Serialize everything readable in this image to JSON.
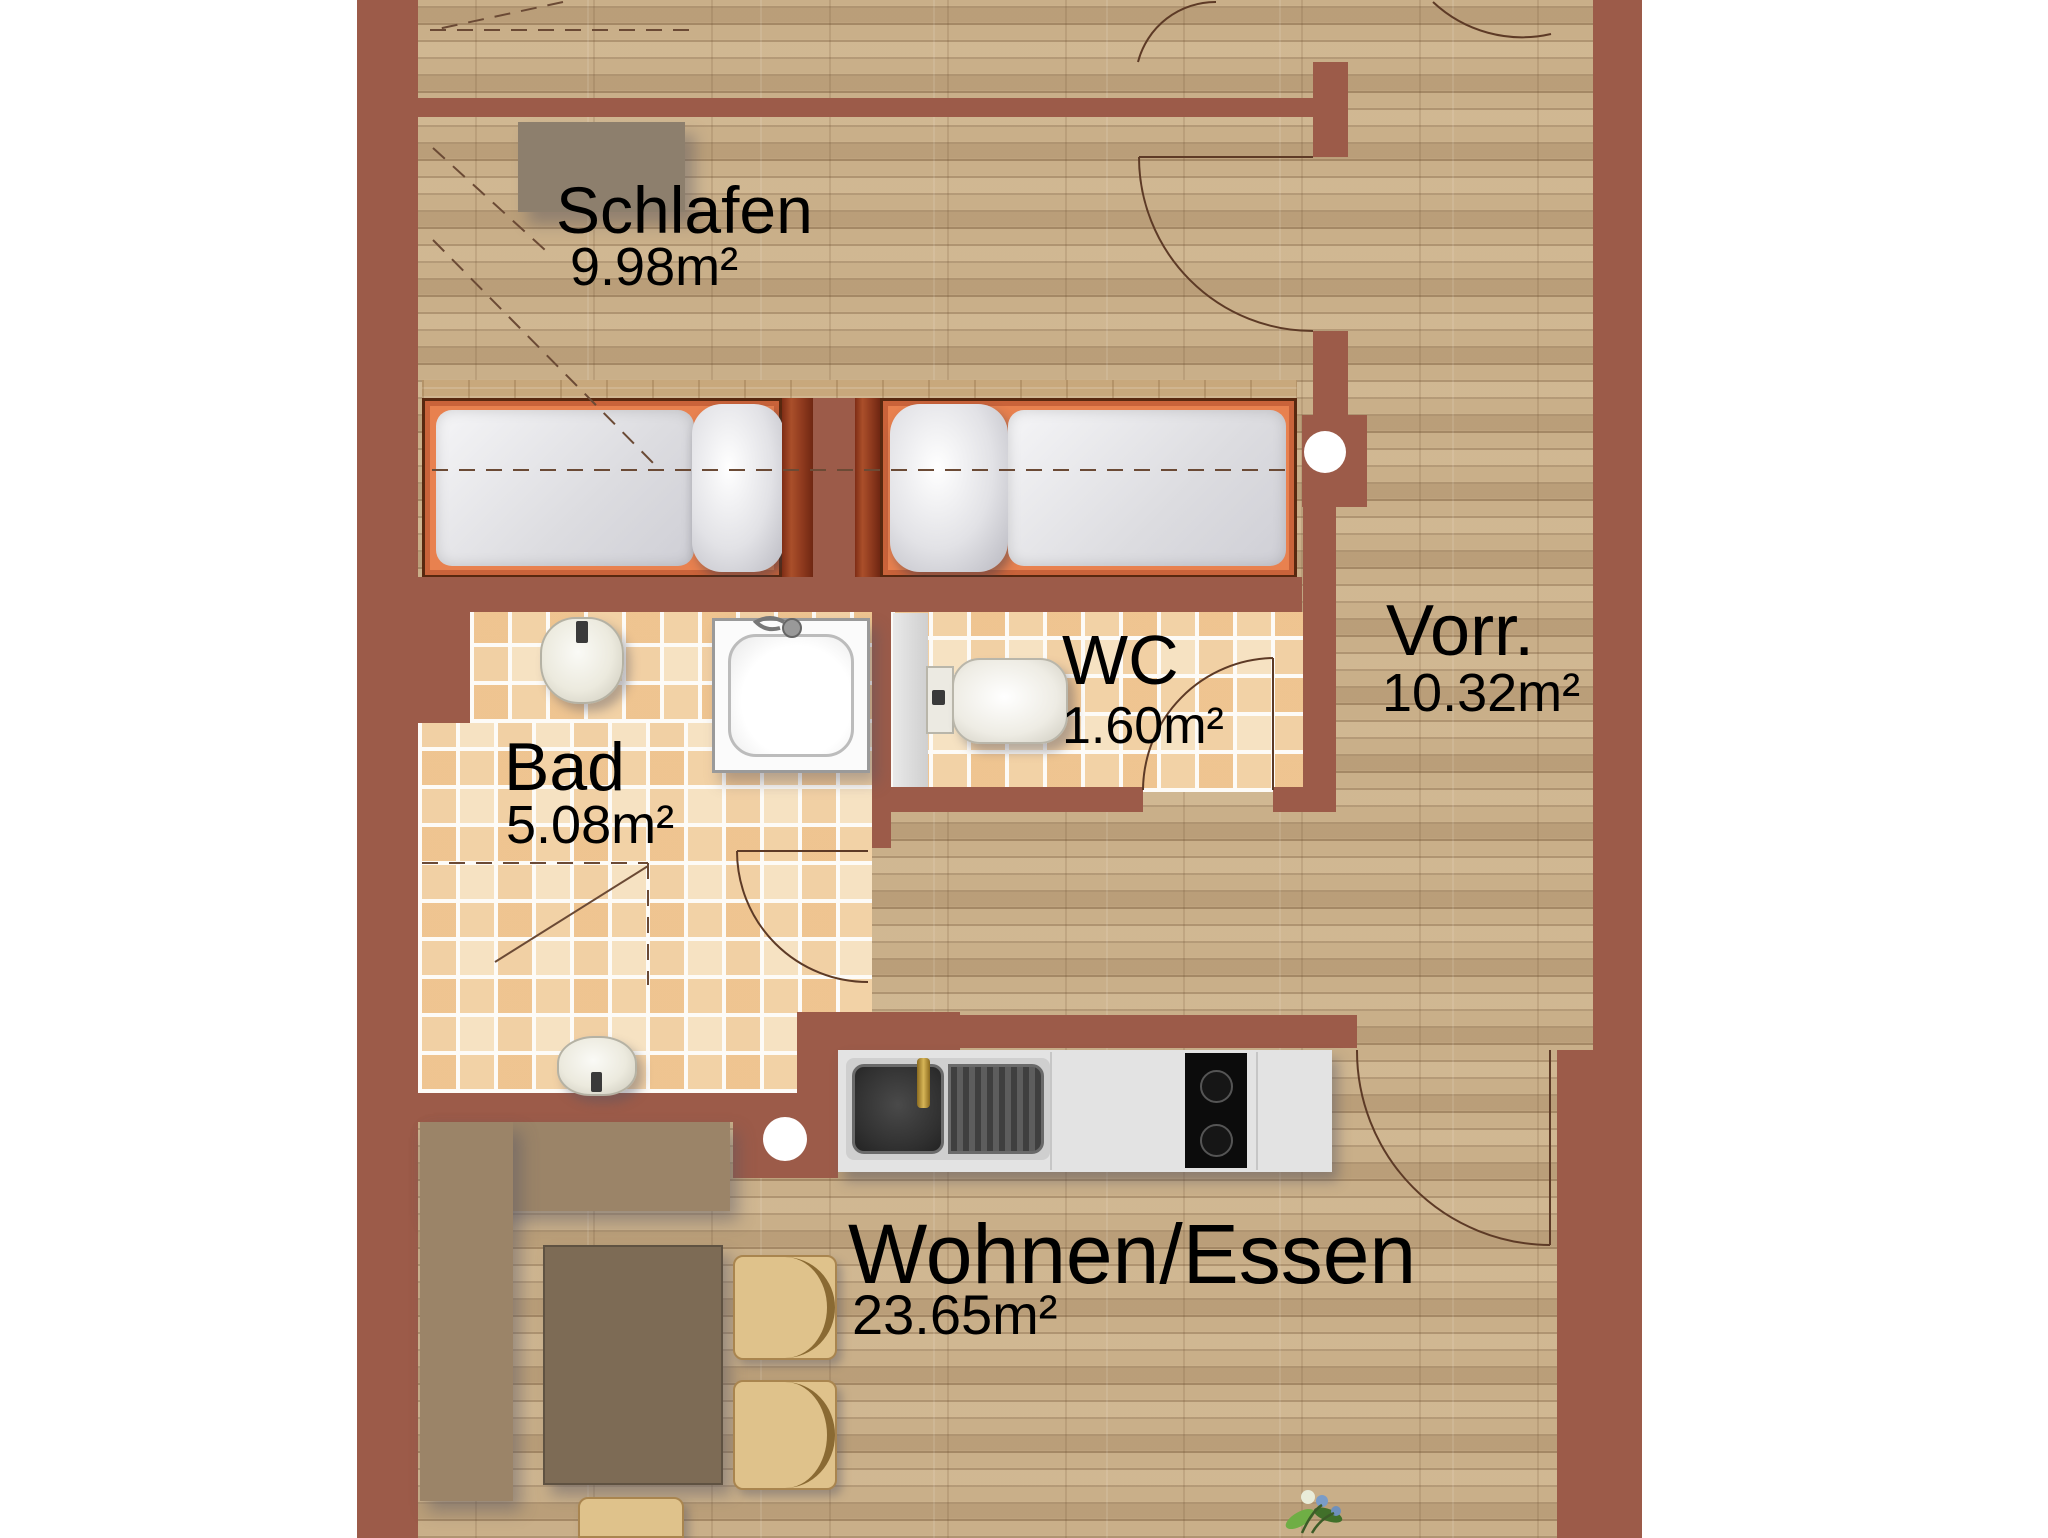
{
  "plan": {
    "type": "apartment-floor-plan",
    "rooms": {
      "schlafen": {
        "label": "Schlafen",
        "area": "9.98m²"
      },
      "bad": {
        "label": "Bad",
        "area": "5.08m²"
      },
      "wc": {
        "label": "WC",
        "area": "1.60m²"
      },
      "vorraum": {
        "label": "Vorr.",
        "area": "10.32m²"
      },
      "wohnen": {
        "label": "Wohnen/Essen",
        "area": "23.65m²"
      }
    },
    "colors": {
      "wall": "#9c5b49",
      "wood_floor": "#c9af89",
      "tile_floor": "#f6e2c2",
      "bed_frame": "#e8814f",
      "headboard_wood": "#8f3a1e",
      "leather": "#c08a3e",
      "cabinet_tan": "#9b8468",
      "table_brown": "#7d6b55",
      "label_text": "#0d0d0d"
    }
  }
}
